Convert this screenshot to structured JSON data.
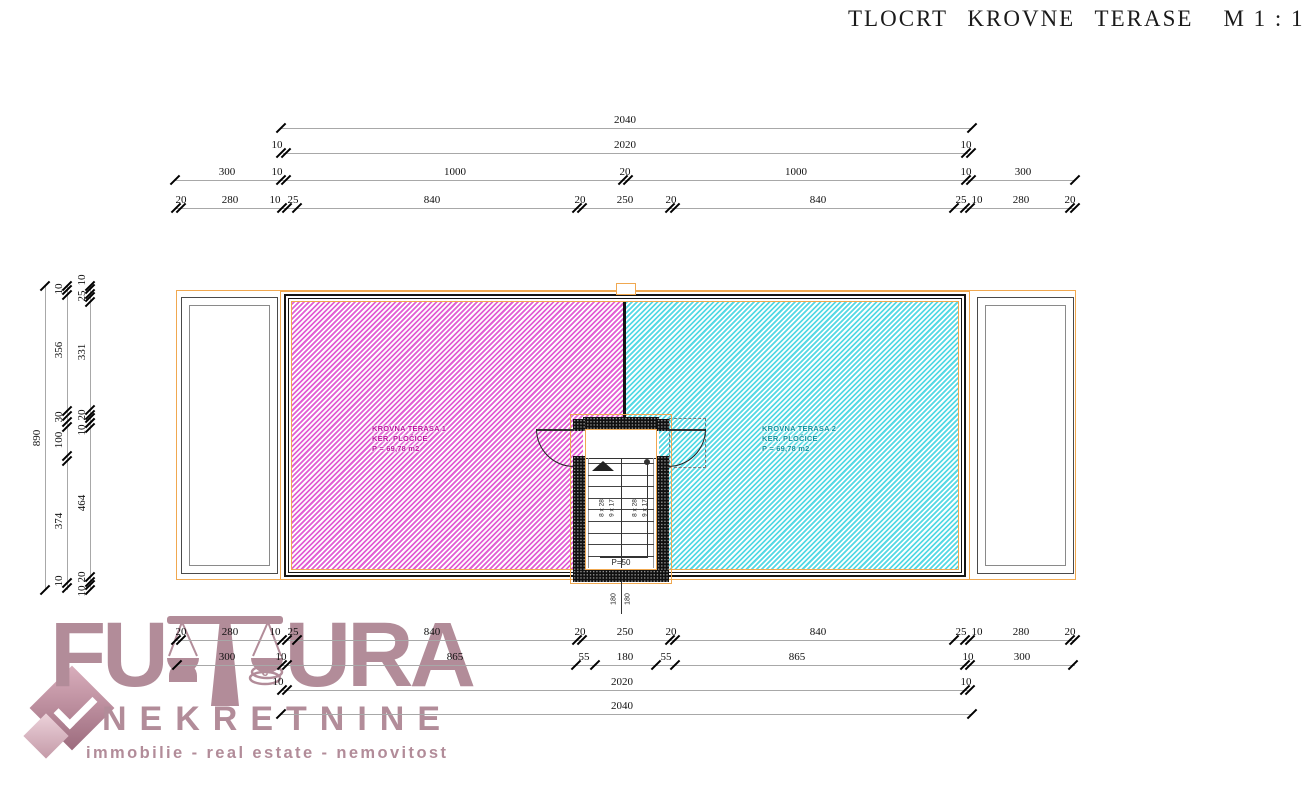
{
  "title": {
    "main": "TLOCRT KROVNE TERASE",
    "scale": "M 1 : 100"
  },
  "colors": {
    "orange_accent": "#f0a850",
    "pink_hatch": "#e25fd4",
    "cyan_hatch": "#55d9e4",
    "terrace1_text": "#bb109f",
    "terrace2_text": "#0a93a0",
    "wall_black": "#101010",
    "dim_line_gray": "#a8a8a8",
    "dim_text": "#111111",
    "logo_mauve": "#b28c99"
  },
  "plan": {
    "terrace1": {
      "name": "KROVNA TERASA 1",
      "material": "KER. PLOČICE",
      "area": "P = 69,78 m2"
    },
    "terrace2": {
      "name": "KROVNA TERASA 2",
      "material": "KER. PLOČICE",
      "area": "P = 69,78 m2"
    },
    "stairs": {
      "left_flight_a": "8 x 28",
      "left_flight_b": "9 x 17",
      "right_flight_a": "8 x 28",
      "right_flight_b": "9 x 17",
      "landing": "P=50",
      "below_left": "180",
      "below_right": "180"
    }
  },
  "logo": {
    "word_start": "FU",
    "word_end": "URA",
    "line2": "NEKRETNINE",
    "line3": "immobilie - real estate - nemovitost"
  },
  "dimensions": {
    "top_rows": [
      {
        "y": 128,
        "x1": 281,
        "x2": 972,
        "ticks": [
          {
            "x": 281
          },
          {
            "x": 972
          }
        ],
        "labels": [
          {
            "t": "2040",
            "x": 625
          }
        ]
      },
      {
        "y": 153,
        "x1": 283,
        "x2": 968,
        "ticks": [
          {
            "x": 283,
            "d": 1
          },
          {
            "x": 968,
            "d": 1
          }
        ],
        "labels": [
          {
            "t": "10",
            "x": 277
          },
          {
            "t": "2020",
            "x": 625
          },
          {
            "t": "10",
            "x": 966
          }
        ]
      },
      {
        "y": 180,
        "x1": 175,
        "x2": 1075,
        "ticks": [
          {
            "x": 175
          },
          {
            "x": 283,
            "d": 1
          },
          {
            "x": 625,
            "d": 1
          },
          {
            "x": 968,
            "d": 1
          },
          {
            "x": 1075
          }
        ],
        "labels": [
          {
            "t": "300",
            "x": 227
          },
          {
            "t": "10",
            "x": 277
          },
          {
            "t": "1000",
            "x": 455
          },
          {
            "t": "20",
            "x": 625
          },
          {
            "t": "1000",
            "x": 796
          },
          {
            "t": "10",
            "x": 966
          },
          {
            "t": "300",
            "x": 1023
          }
        ]
      },
      {
        "y": 208,
        "x1": 175,
        "x2": 1075,
        "ticks": [
          {
            "x": 178,
            "d": 1
          },
          {
            "x": 284,
            "d": 1
          },
          {
            "x": 297
          },
          {
            "x": 579,
            "d": 1
          },
          {
            "x": 672,
            "d": 1
          },
          {
            "x": 954
          },
          {
            "x": 967,
            "d": 1
          },
          {
            "x": 1072,
            "d": 1
          }
        ],
        "labels": [
          {
            "t": "20",
            "x": 181
          },
          {
            "t": "280",
            "x": 230
          },
          {
            "t": "10",
            "x": 275
          },
          {
            "t": "25",
            "x": 293
          },
          {
            "t": "840",
            "x": 432
          },
          {
            "t": "20",
            "x": 580
          },
          {
            "t": "250",
            "x": 625
          },
          {
            "t": "20",
            "x": 671
          },
          {
            "t": "840",
            "x": 818
          },
          {
            "t": "25",
            "x": 961
          },
          {
            "t": "10",
            "x": 977
          },
          {
            "t": "280",
            "x": 1021
          },
          {
            "t": "20",
            "x": 1070
          }
        ]
      }
    ],
    "bottom_rows": [
      {
        "y": 640,
        "x1": 175,
        "x2": 1075,
        "ticks": [
          {
            "x": 178,
            "d": 1
          },
          {
            "x": 284,
            "d": 1
          },
          {
            "x": 297
          },
          {
            "x": 579,
            "d": 1
          },
          {
            "x": 672,
            "d": 1
          },
          {
            "x": 954
          },
          {
            "x": 967,
            "d": 1
          },
          {
            "x": 1072,
            "d": 1
          }
        ],
        "labels": [
          {
            "t": "20",
            "x": 181
          },
          {
            "t": "280",
            "x": 230
          },
          {
            "t": "10",
            "x": 275
          },
          {
            "t": "25",
            "x": 293
          },
          {
            "t": "840",
            "x": 432
          },
          {
            "t": "20",
            "x": 580
          },
          {
            "t": "250",
            "x": 625
          },
          {
            "t": "20",
            "x": 671
          },
          {
            "t": "840",
            "x": 818
          },
          {
            "t": "25",
            "x": 961
          },
          {
            "t": "10",
            "x": 977
          },
          {
            "t": "280",
            "x": 1021
          },
          {
            "t": "20",
            "x": 1070
          }
        ]
      },
      {
        "y": 665,
        "x1": 175,
        "x2": 1075,
        "ticks": [
          {
            "x": 177
          },
          {
            "x": 284,
            "d": 1
          },
          {
            "x": 576
          },
          {
            "x": 595
          },
          {
            "x": 656
          },
          {
            "x": 675
          },
          {
            "x": 967,
            "d": 1
          },
          {
            "x": 1073
          }
        ],
        "labels": [
          {
            "t": "300",
            "x": 227
          },
          {
            "t": "10",
            "x": 281
          },
          {
            "t": "865",
            "x": 455
          },
          {
            "t": "55",
            "x": 584
          },
          {
            "t": "180",
            "x": 625
          },
          {
            "t": "55",
            "x": 666
          },
          {
            "t": "865",
            "x": 797
          },
          {
            "t": "10",
            "x": 968
          },
          {
            "t": "300",
            "x": 1022
          }
        ]
      },
      {
        "y": 690,
        "x1": 283,
        "x2": 968,
        "ticks": [
          {
            "x": 284,
            "d": 1
          },
          {
            "x": 967,
            "d": 1
          }
        ],
        "labels": [
          {
            "t": "10",
            "x": 278
          },
          {
            "t": "2020",
            "x": 622
          },
          {
            "t": "10",
            "x": 966
          }
        ]
      },
      {
        "y": 714,
        "x1": 281,
        "x2": 972,
        "ticks": [
          {
            "x": 281
          },
          {
            "x": 972
          }
        ],
        "labels": [
          {
            "t": "2040",
            "x": 622
          }
        ]
      }
    ],
    "left_cols": [
      {
        "x": 45,
        "y1": 286,
        "y2": 590,
        "ticks": [
          {
            "y": 286
          },
          {
            "y": 590
          }
        ],
        "labels": [
          {
            "t": "890",
            "y": 438
          }
        ]
      },
      {
        "x": 67,
        "y1": 286,
        "y2": 590,
        "ticks": [
          {
            "y": 286
          },
          {
            "y": 292,
            "d": 1
          },
          {
            "y": 413,
            "d": 1
          },
          {
            "y": 424,
            "d": 1
          },
          {
            "y": 458,
            "d": 1
          },
          {
            "y": 585,
            "d": 1
          }
        ],
        "labels": [
          {
            "t": "10",
            "y": 289
          },
          {
            "t": "356",
            "y": 350
          },
          {
            "t": "30",
            "y": 417
          },
          {
            "t": "100",
            "y": 440
          },
          {
            "t": "374",
            "y": 521
          },
          {
            "t": "10",
            "y": 581
          }
        ]
      },
      {
        "x": 90,
        "y1": 286,
        "y2": 590,
        "ticks": [
          {
            "y": 286
          },
          {
            "y": 291,
            "d": 1
          },
          {
            "y": 299,
            "d": 1
          },
          {
            "y": 412,
            "d": 1
          },
          {
            "y": 420,
            "d": 1
          },
          {
            "y": 425,
            "d": 1
          },
          {
            "y": 579,
            "d": 1
          },
          {
            "y": 587,
            "d": 1
          }
        ],
        "labels": [
          {
            "t": "10",
            "y": 280
          },
          {
            "t": "25",
            "y": 296
          },
          {
            "t": "331",
            "y": 352
          },
          {
            "t": "20",
            "y": 415
          },
          {
            "t": "10",
            "y": 430
          },
          {
            "t": "464",
            "y": 503
          },
          {
            "t": "20",
            "y": 577
          },
          {
            "t": "10",
            "y": 591
          }
        ]
      }
    ]
  }
}
